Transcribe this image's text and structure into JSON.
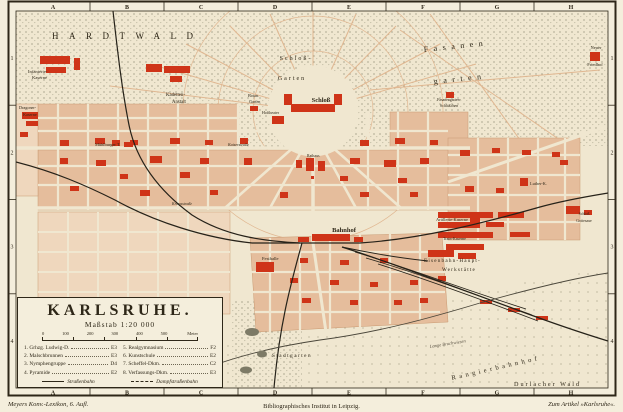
{
  "imprint": {
    "bottom_left": "Meyers Konv.-Lexikon, 6. Aufl.",
    "bottom_center": "Bibliographisches Institut in Leipzig.",
    "bottom_right": "Zum Artikel »Karlsruhe«."
  },
  "frame": {
    "cols": [
      "A",
      "B",
      "C",
      "D",
      "E",
      "F",
      "G",
      "H"
    ],
    "rows": [
      "1",
      "2",
      "3",
      "4"
    ]
  },
  "title_box": {
    "title": "KARLSRUHE.",
    "scale_label": "Maßstab 1:20 000",
    "scale_ticks": [
      "0",
      "100",
      "200",
      "300",
      "400",
      "500"
    ],
    "scale_unit": "Meter",
    "legend": [
      {
        "label": "1. Grhzg. Ludwig-D.",
        "grid": "E3"
      },
      {
        "label": "2. Malschbrunnen",
        "grid": "E3"
      },
      {
        "label": "3. Nymphengruppe",
        "grid": "D4"
      },
      {
        "label": "4. Pyramide",
        "grid": "E2"
      },
      {
        "label": "5. Realgymnasium",
        "grid": "F2"
      },
      {
        "label": "6. Kunstschule",
        "grid": "E2"
      },
      {
        "label": "7. Scheffel-Dkm.",
        "grid": "C2"
      },
      {
        "label": "8. Verfassungs-Dkm.",
        "grid": "E3"
      }
    ],
    "tram_legend": [
      {
        "style": "solid",
        "label": "Straßenbahn"
      },
      {
        "style": "dashed",
        "label": "Dampfstraßenbahn"
      }
    ]
  },
  "map_labels": [
    {
      "t": "HARDTWALD",
      "x": 52,
      "y": 39,
      "s": 9,
      "ls": 10.5
    },
    {
      "t": "Infanterie-",
      "x": 28,
      "y": 73,
      "s": 4.6
    },
    {
      "t": "Kaserne",
      "x": 32,
      "y": 79,
      "s": 4.6
    },
    {
      "t": "Kadetten-",
      "x": 166,
      "y": 96,
      "s": 4.8
    },
    {
      "t": "Anstalt",
      "x": 172,
      "y": 103,
      "s": 4.8
    },
    {
      "t": "Schloß-",
      "x": 296,
      "y": 60,
      "s": 6,
      "ls": 2,
      "a": "middle"
    },
    {
      "t": "Garten",
      "x": 292,
      "y": 80,
      "s": 6,
      "ls": 2,
      "a": "middle"
    },
    {
      "t": "Schloß",
      "x": 321,
      "y": 102,
      "s": 6.5,
      "fw": "bold",
      "a": "middle"
    },
    {
      "t": "Fasanen",
      "x": 424,
      "y": 52,
      "s": 8,
      "ls": 5.5,
      "rot": -6
    },
    {
      "t": "garten",
      "x": 434,
      "y": 84,
      "s": 8,
      "ls": 5.5,
      "rot": -6
    },
    {
      "t": "Neuer",
      "x": 596,
      "y": 49,
      "s": 4.5,
      "a": "middle"
    },
    {
      "t": "Friedhof",
      "x": 595,
      "y": 66,
      "s": 4.5,
      "a": "middle"
    },
    {
      "t": "Fasanengarten-",
      "x": 449,
      "y": 101,
      "s": 3.9,
      "a": "middle"
    },
    {
      "t": "Schlößchen",
      "x": 449,
      "y": 107,
      "s": 3.9,
      "a": "middle"
    },
    {
      "t": "Botan.",
      "x": 248,
      "y": 97,
      "s": 4.2
    },
    {
      "t": "Garten",
      "x": 249,
      "y": 103,
      "s": 4.2
    },
    {
      "t": "Hoftheater",
      "x": 262,
      "y": 114,
      "s": 4
    },
    {
      "t": "Mühlburger T.",
      "x": 95,
      "y": 146,
      "s": 4.4
    },
    {
      "t": "Kaiserstraße",
      "x": 228,
      "y": 146,
      "s": 4,
      "fs": "italic"
    },
    {
      "t": "Rathaus",
      "x": 307,
      "y": 157,
      "s": 3.9
    },
    {
      "t": "Bahnhof",
      "x": 344,
      "y": 232,
      "s": 6.5,
      "fw": "bold",
      "a": "middle"
    },
    {
      "t": "Festhalle",
      "x": 262,
      "y": 260,
      "s": 4.6
    },
    {
      "t": "Stadtgarten",
      "x": 292,
      "y": 357,
      "s": 5.2,
      "ls": 1.5,
      "a": "middle"
    },
    {
      "t": "Vincentius-",
      "x": 143,
      "y": 323,
      "s": 4.6,
      "fw": "bold"
    },
    {
      "t": "Krankenhaus",
      "x": 139,
      "y": 330,
      "s": 4.6,
      "fw": "bold"
    },
    {
      "t": "Eisenbahn-Haupt-",
      "x": 424,
      "y": 262,
      "s": 5.2,
      "ls": 1.2
    },
    {
      "t": "Werkstätte",
      "x": 442,
      "y": 271,
      "s": 5.2,
      "ls": 1.2
    },
    {
      "t": "Rangierbahnhof",
      "x": 452,
      "y": 380,
      "s": 6.5,
      "ls": 3.5,
      "rot": -13
    },
    {
      "t": "Durlacher Wald",
      "x": 514,
      "y": 386,
      "s": 6.2,
      "ls": 2
    },
    {
      "t": "Lange Bruchwiesen",
      "x": 430,
      "y": 348,
      "s": 4.6,
      "fs": "italic",
      "rot": -9,
      "c": "#5a5344"
    },
    {
      "t": "Artillerie-Kaserne",
      "x": 436,
      "y": 221,
      "s": 4.4
    },
    {
      "t": "Train-Kaserne",
      "x": 443,
      "y": 240,
      "s": 4
    },
    {
      "t": "Luther-K.",
      "x": 530,
      "y": 185,
      "s": 4.3
    },
    {
      "t": "Schloß",
      "x": 584,
      "y": 215,
      "s": 3.9,
      "a": "middle"
    },
    {
      "t": "Gottesaue",
      "x": 584,
      "y": 222,
      "s": 3.9,
      "a": "middle"
    },
    {
      "t": "Dragoner-",
      "x": 19,
      "y": 109,
      "s": 4.2
    },
    {
      "t": "Kaserne",
      "x": 23,
      "y": 116,
      "s": 4.2
    },
    {
      "t": "Kriegsstraße",
      "x": 172,
      "y": 205,
      "s": 3.9,
      "fs": "italic"
    },
    {
      "t": "n. Mannhm.",
      "x": 240,
      "y": 9,
      "s": 4.2,
      "fs": "italic",
      "c": "#5a5344"
    },
    {
      "t": "n. Eggenstein",
      "x": 294,
      "y": 9,
      "s": 4.2,
      "fs": "italic",
      "c": "#5a5344"
    },
    {
      "t": "n. Beiertheim",
      "x": 160,
      "y": 394,
      "s": 4.2,
      "fs": "italic",
      "c": "#5a5344"
    },
    {
      "t": "n. Ettlingen",
      "x": 228,
      "y": 394,
      "s": 4.2,
      "fs": "italic",
      "c": "#5a5344"
    },
    {
      "t": "n. Mühlburg",
      "x": 5,
      "y": 150,
      "s": 4.2,
      "fs": "italic",
      "c": "#5a5344",
      "rot": -90,
      "a": "middle"
    },
    {
      "t": "n. Durlach",
      "x": 612,
      "y": 140,
      "s": 4.2,
      "fs": "italic",
      "rot": 90,
      "c": "#5a5344",
      "a": "middle"
    }
  ],
  "colors": {
    "paper": "#f4eedc",
    "paper-map": "#f0e7d0",
    "salmon": "#e5bd9c",
    "salmon-light": "#efd7bd",
    "salmon-edge": "#c99a72",
    "red": "#cf3418",
    "ink": "#2e2718",
    "gray": "#5a5344",
    "rail": "#262219",
    "forest-dot": "#8d8a72"
  }
}
